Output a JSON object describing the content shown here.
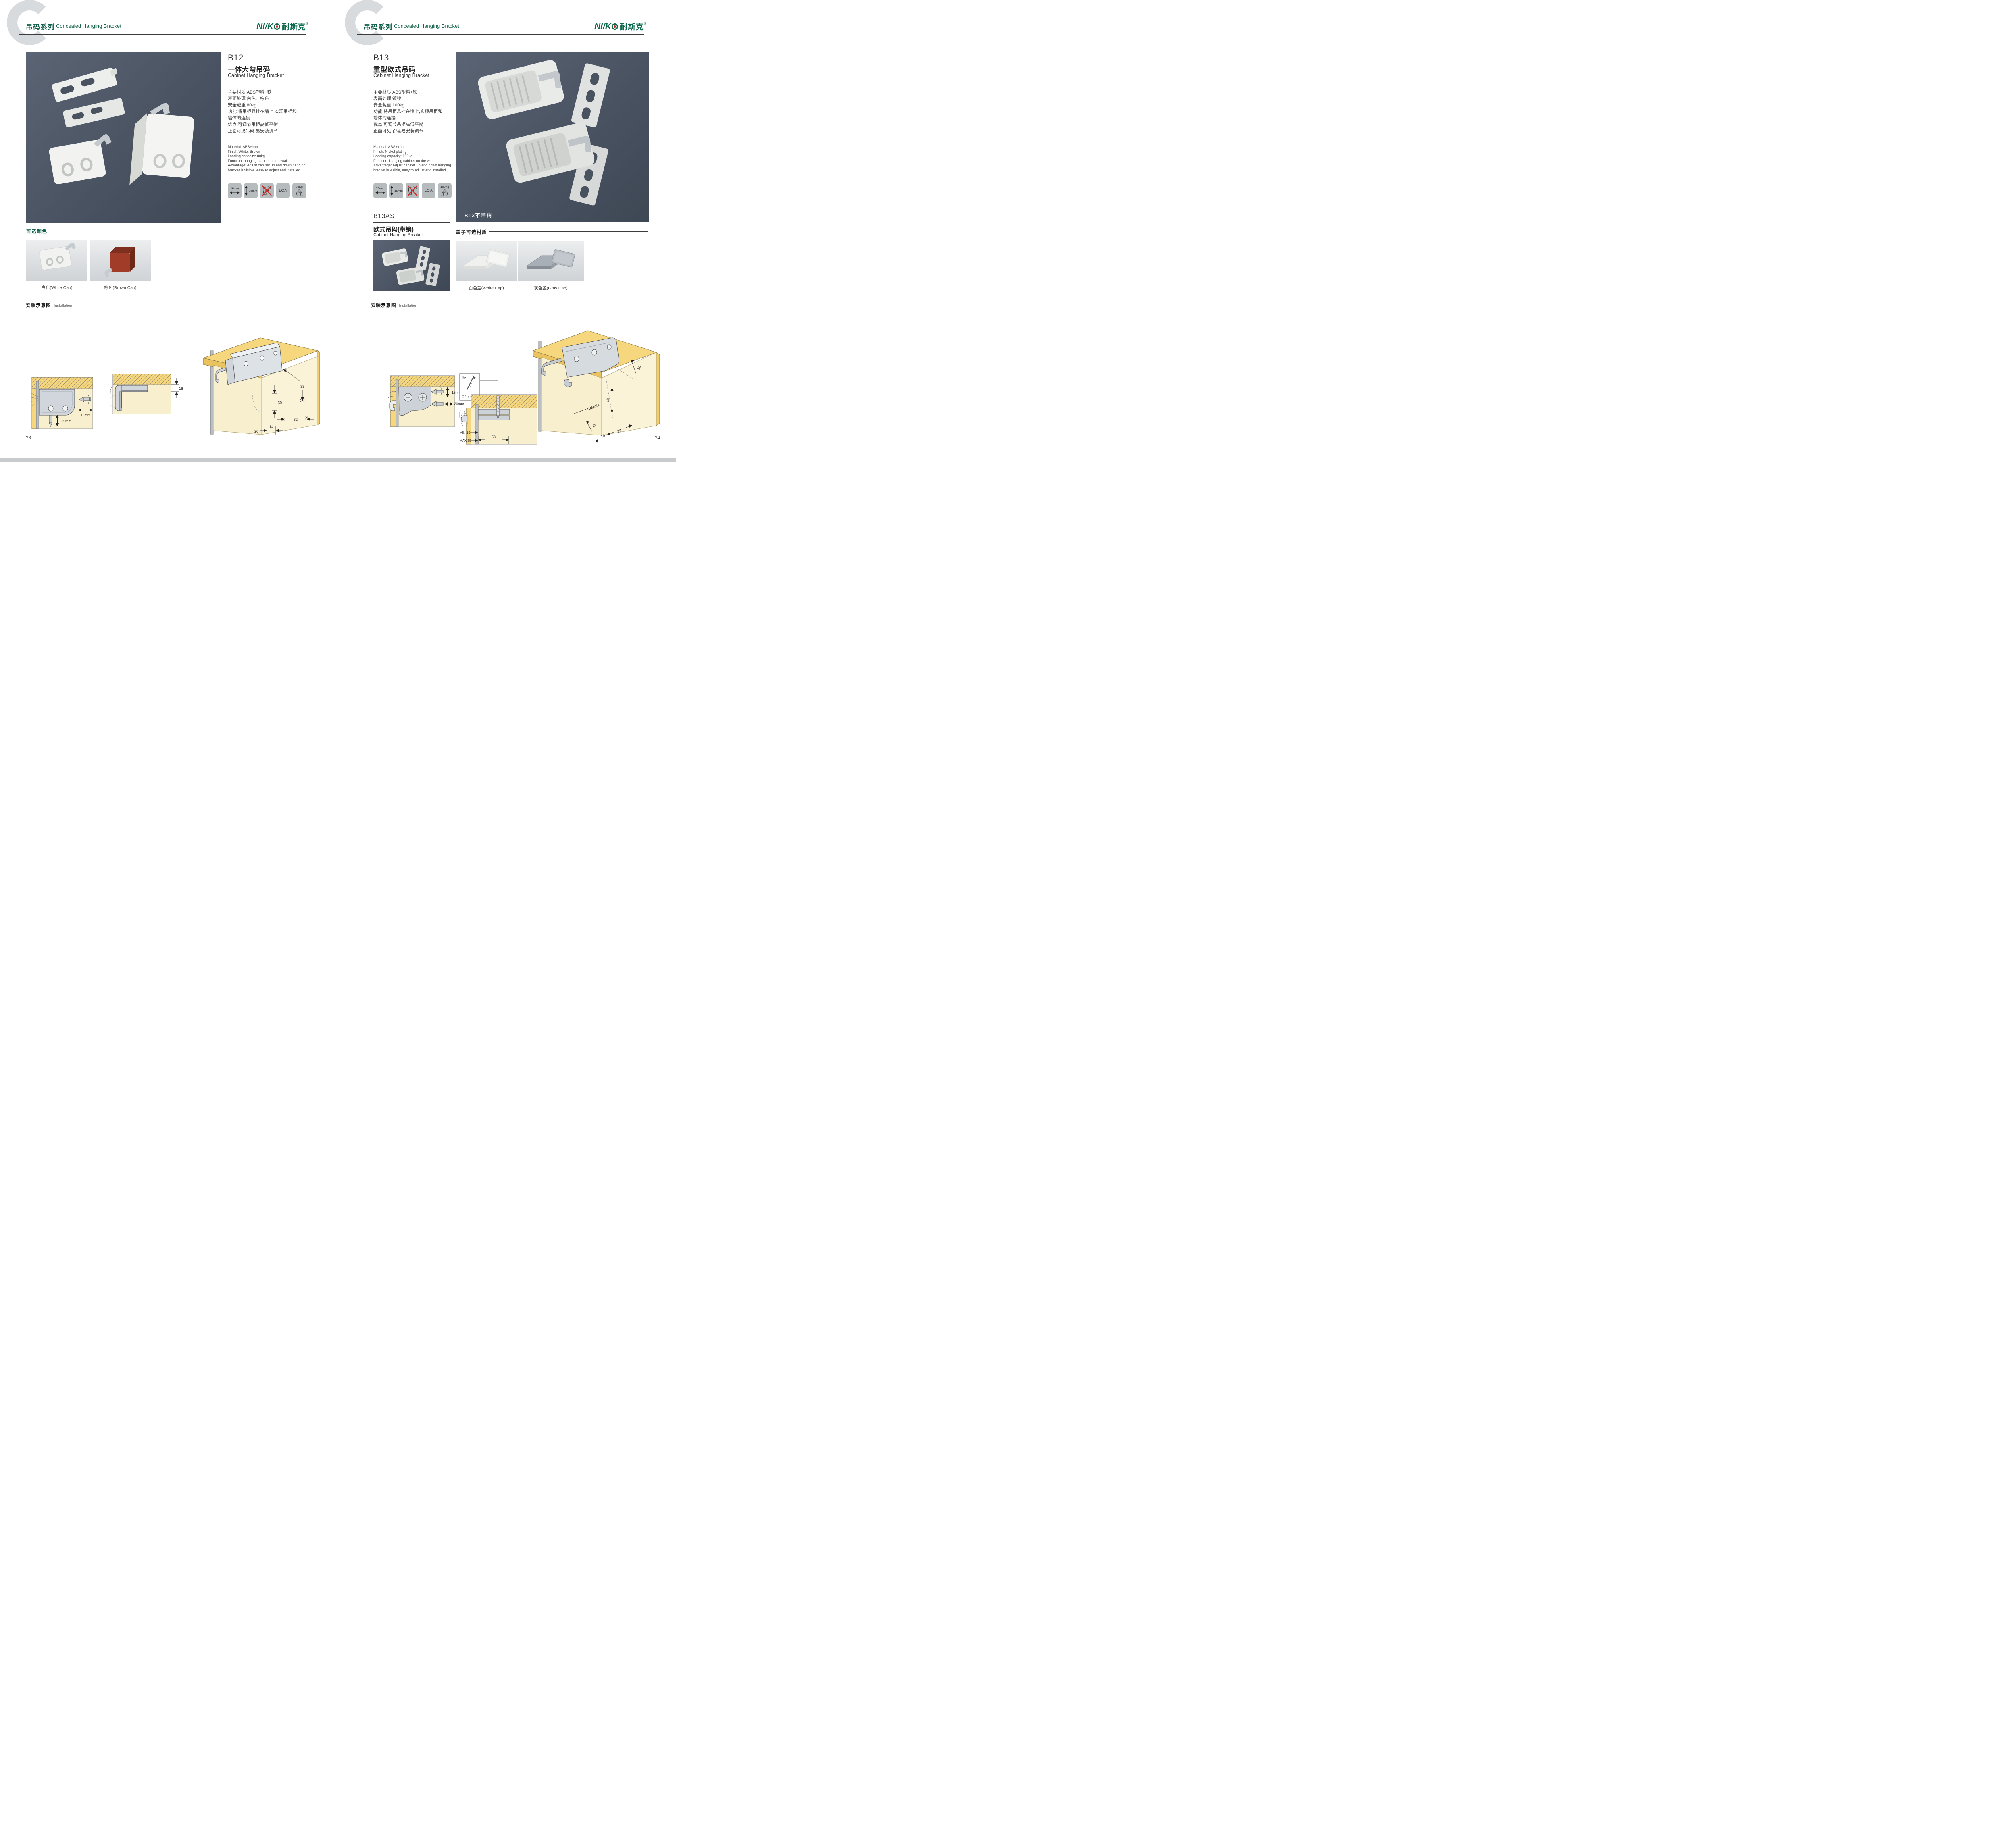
{
  "brand": {
    "wordmark": "NI/K",
    "cn": "耐斯克",
    "registered": "®"
  },
  "header": {
    "series_cn": "吊码系列",
    "series_en": "Concealed Hanging Bracket",
    "series_letter": "C"
  },
  "install_title": {
    "cn": "安装示意图",
    "en": "Installation"
  },
  "icon_names": [
    "width-arrow",
    "height-arrow",
    "no-drill",
    "lga-cert",
    "max-load"
  ],
  "left": {
    "product": {
      "code": "B12",
      "name_cn": "一体大勾吊码",
      "name_en": "Cabinet Hanging Bracket",
      "specs_cn": [
        "主要材质:ABS塑料+铁",
        "表面处理:白色、棕色",
        "安全载重:80kg",
        "功能:将吊柜悬挂在墙上,实现吊柜和",
        "墙体的连接",
        "优点:可调节吊柜高低平衡",
        "正面可见吊码,易安装调节"
      ],
      "specs_en": [
        "Material: ABS+iron",
        "Finish:White, Brown",
        "Loading capacity: 80kg",
        "Function: hanging cabinet on the wall",
        "Advantage: Adjust cabinet up and down hanging",
        "bracket is visible, easy to adjust and installed"
      ],
      "icons": {
        "width": "16mm",
        "height": "15mm",
        "cert": "LGA",
        "load": "80Kg"
      }
    },
    "colors": {
      "title": "可选颜色",
      "white": "白色(White Cap)",
      "brown": "棕色(Brown Cap)"
    },
    "install": {
      "d1": {
        "w": "16mm",
        "h": "15mm"
      },
      "d2": {
        "t": "18"
      },
      "d3": {
        "a": "33",
        "b": "30",
        "c": "32",
        "d": "20",
        "e": "14"
      }
    },
    "page_number": "73"
  },
  "right": {
    "product": {
      "code": "B13",
      "name_cn": "重型欧式吊码",
      "name_en": "Cabinet Hanging Bracket",
      "specs_cn": [
        "主要材质:ABS塑料+铁",
        "表面处理:镀镍",
        "安全载重:100kg",
        "功能:将吊柜悬挂在墙上,实现吊柜和",
        "墙体的连接",
        "优点:可调节吊柜高低平衡",
        "正面可见吊码,易安装调节"
      ],
      "specs_en": [
        "Material: ABS+iron",
        "Finish: Nickel plating",
        "Loading capacity: 100kg",
        "Function: hanging cabinet on the wall",
        "Advantage: Adjust cabinet up and down hanging",
        "bracket is visible, easy to adjust and installed"
      ],
      "icons": {
        "width": "20mm",
        "height": "15mm",
        "cert": "LGA",
        "load": "100Kg"
      },
      "photo_label": "B13不带销"
    },
    "sub_product": {
      "code": "B13AS",
      "name_cn": "欧式吊码(带销)",
      "name_en": "Cabinet Hanging Brcaket"
    },
    "caps": {
      "title": "盖子可选材质",
      "white": "白色盖(White Cap)",
      "gray": "灰色盖(Gray Cap)"
    },
    "install": {
      "d1": {
        "h": "15mm",
        "w": "20mm"
      },
      "d2": {
        "qty": "2x",
        "dia": "Φ4mm",
        "t": "18",
        "min": "MIN.15",
        "max": "MAX.35",
        "w": "58"
      },
      "d3": {
        "a": "16",
        "b": "40",
        "c": "RMAX4",
        "d": "19",
        "e": "18",
        "f": "32"
      }
    },
    "page_number": "74"
  }
}
